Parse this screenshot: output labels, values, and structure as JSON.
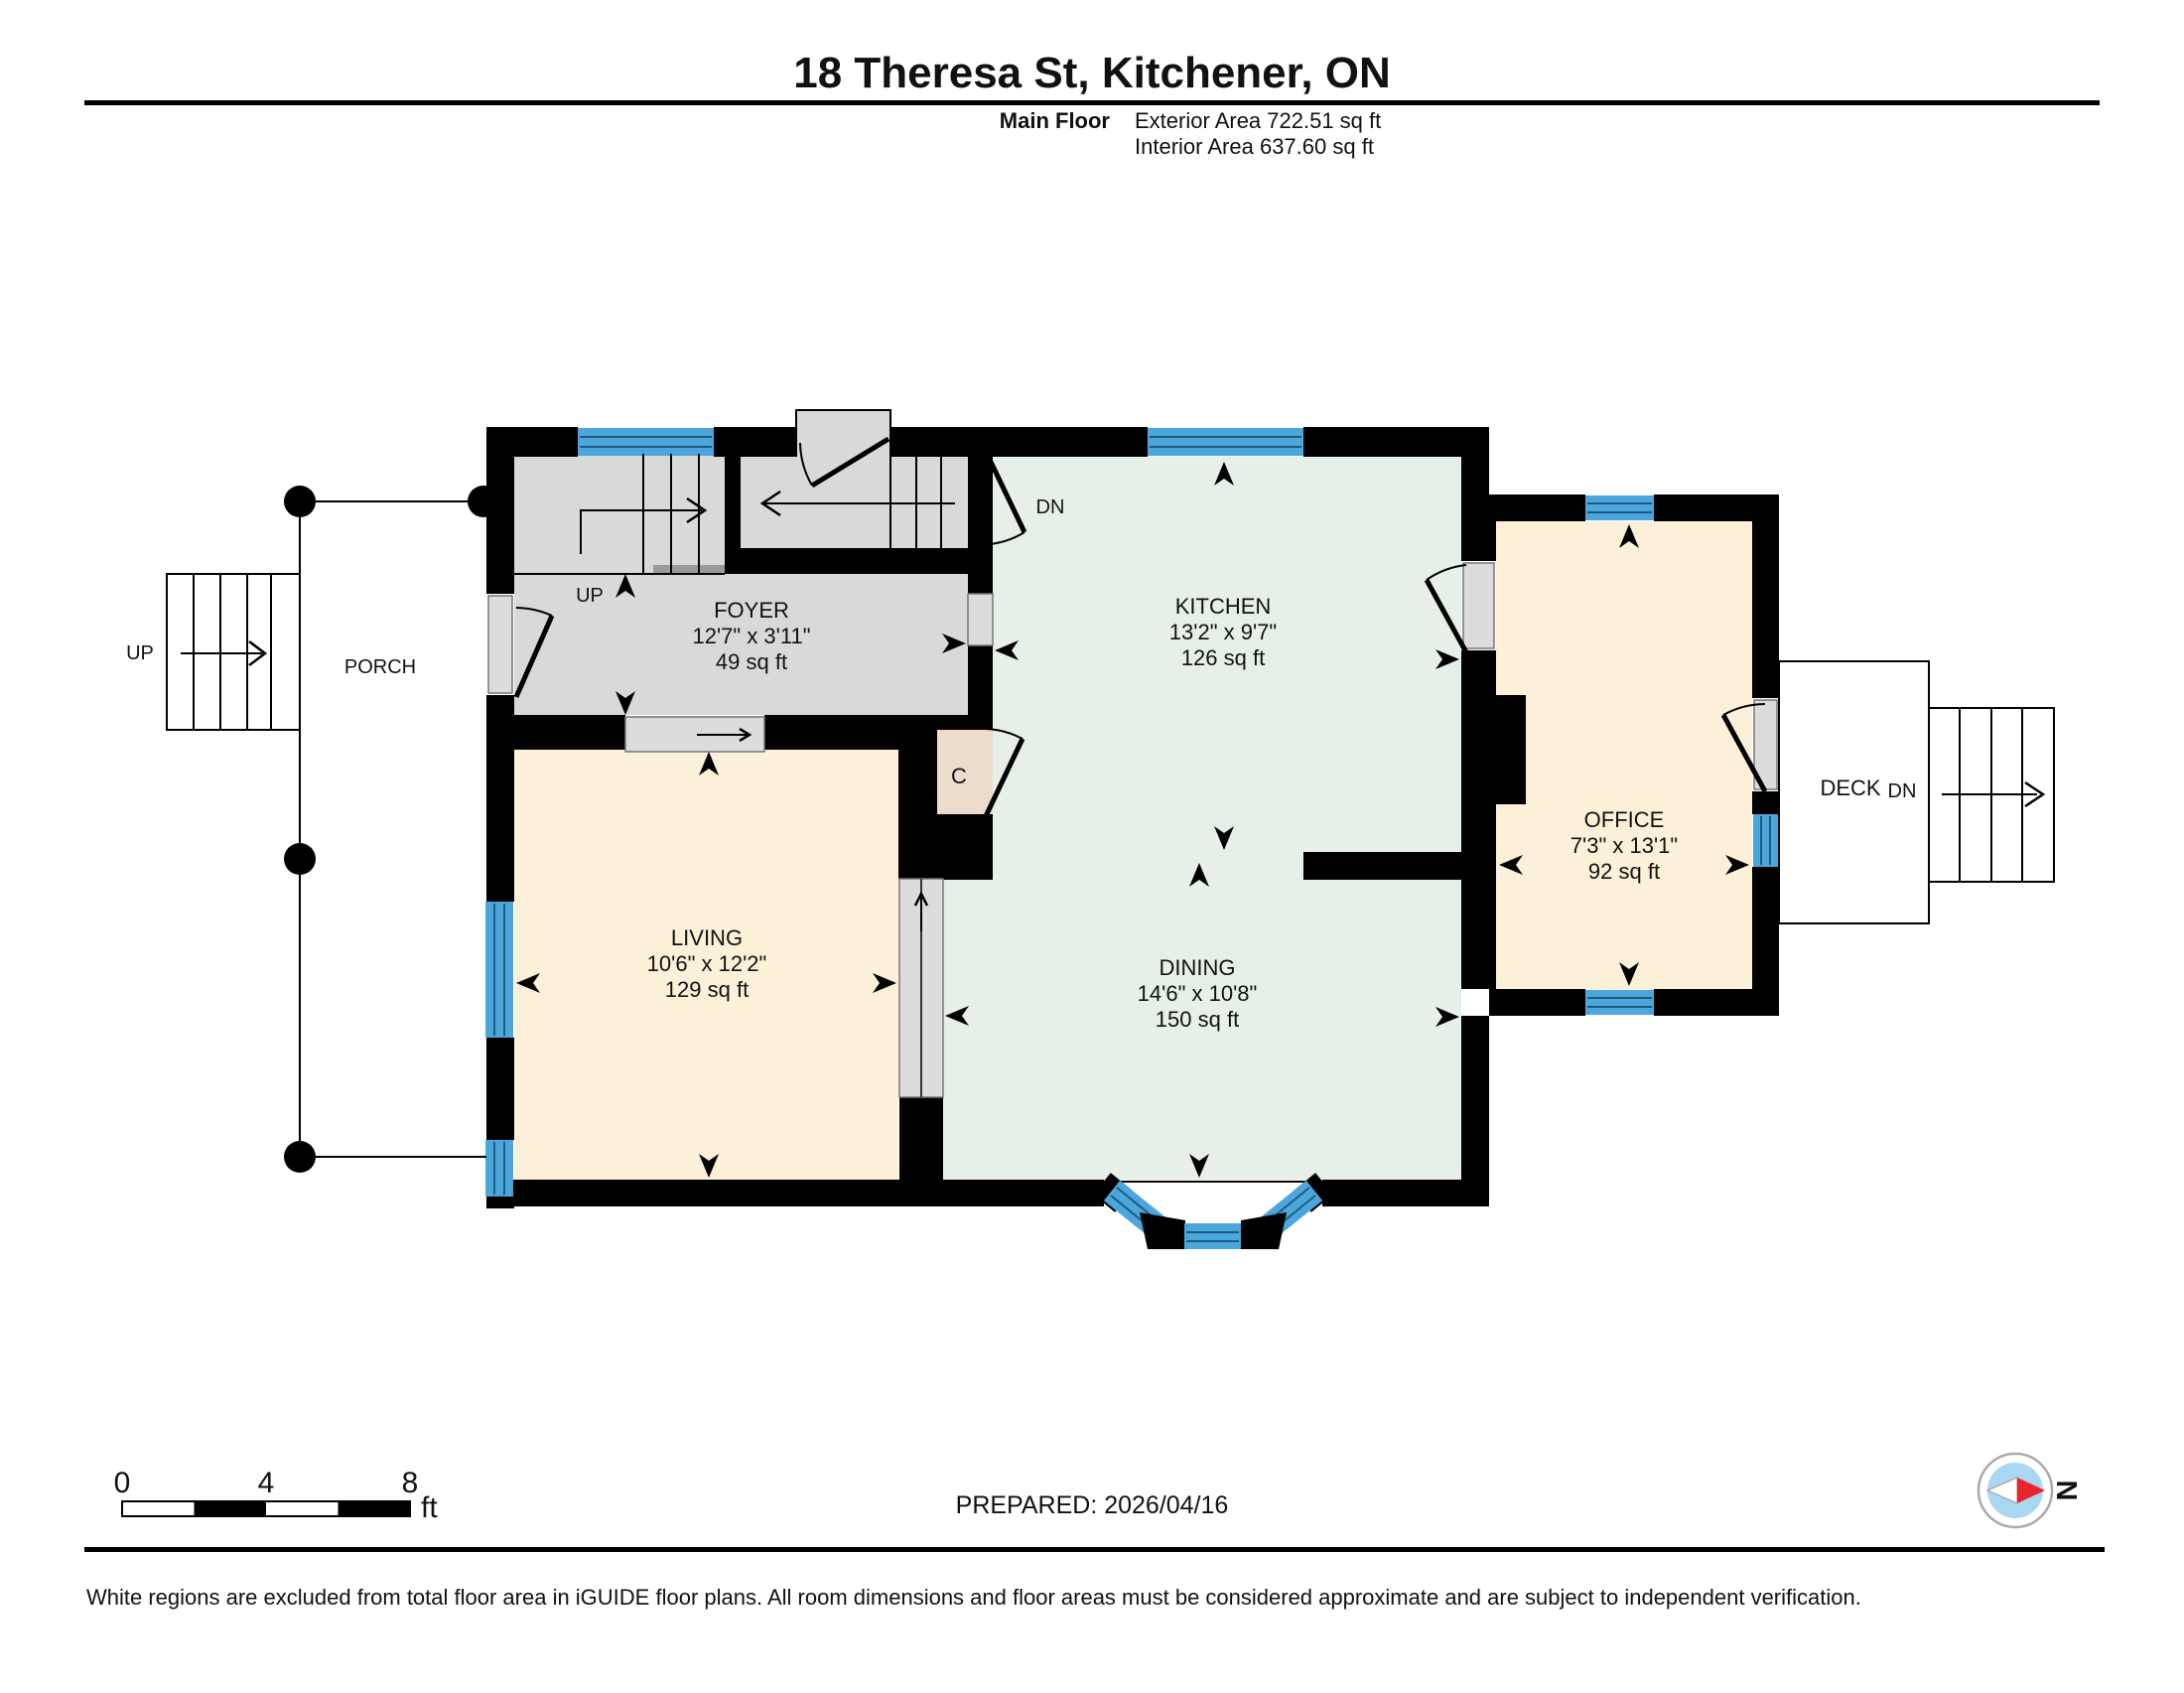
{
  "header": {
    "title": "18 Theresa St, Kitchener, ON",
    "floor_label": "Main Floor",
    "exterior_area": "Exterior Area 722.51 sq ft",
    "interior_area": "Interior Area 637.60 sq ft"
  },
  "rooms": {
    "foyer": {
      "name": "FOYER",
      "dims": "12'7\" x 3'11\"",
      "area": "49 sq ft"
    },
    "kitchen": {
      "name": "KITCHEN",
      "dims": "13'2\" x 9'7\"",
      "area": "126 sq ft"
    },
    "living": {
      "name": "LIVING",
      "dims": "10'6\" x 12'2\"",
      "area": "129 sq ft"
    },
    "dining": {
      "name": "DINING",
      "dims": "14'6\" x 10'8\"",
      "area": "150 sq ft"
    },
    "office": {
      "name": "OFFICE",
      "dims": "7'3\" x 13'1\"",
      "area": "92 sq ft"
    },
    "porch": {
      "name": "PORCH"
    },
    "deck": {
      "name": "DECK"
    },
    "closet": {
      "name": "C"
    }
  },
  "stairs": {
    "up": "UP",
    "down": "DN"
  },
  "scale_bar": {
    "tick0": "0",
    "tick1": "4",
    "tick2": "8",
    "unit": "ft"
  },
  "footer": {
    "prepared": "PREPARED: 2026/04/16",
    "disclaimer": "White regions are excluded from total floor area in iGUIDE floor plans. All room dimensions and floor areas must be considered approximate and are subject to independent verification.",
    "compass_label": "N"
  },
  "colors": {
    "wall_black": "#000000",
    "window_blue": "#4BA7DB",
    "window_line": "#1E5A80",
    "room_gray": "#D9D9D9",
    "room_mint": "#E6F0E9",
    "room_cream": "#FCF1D8",
    "closet_beige": "#EBDCCB",
    "door_slab_gray": "#DCDCDC",
    "compass_red": "#E8252A",
    "compass_inner_blue": "#A9D7F2"
  }
}
